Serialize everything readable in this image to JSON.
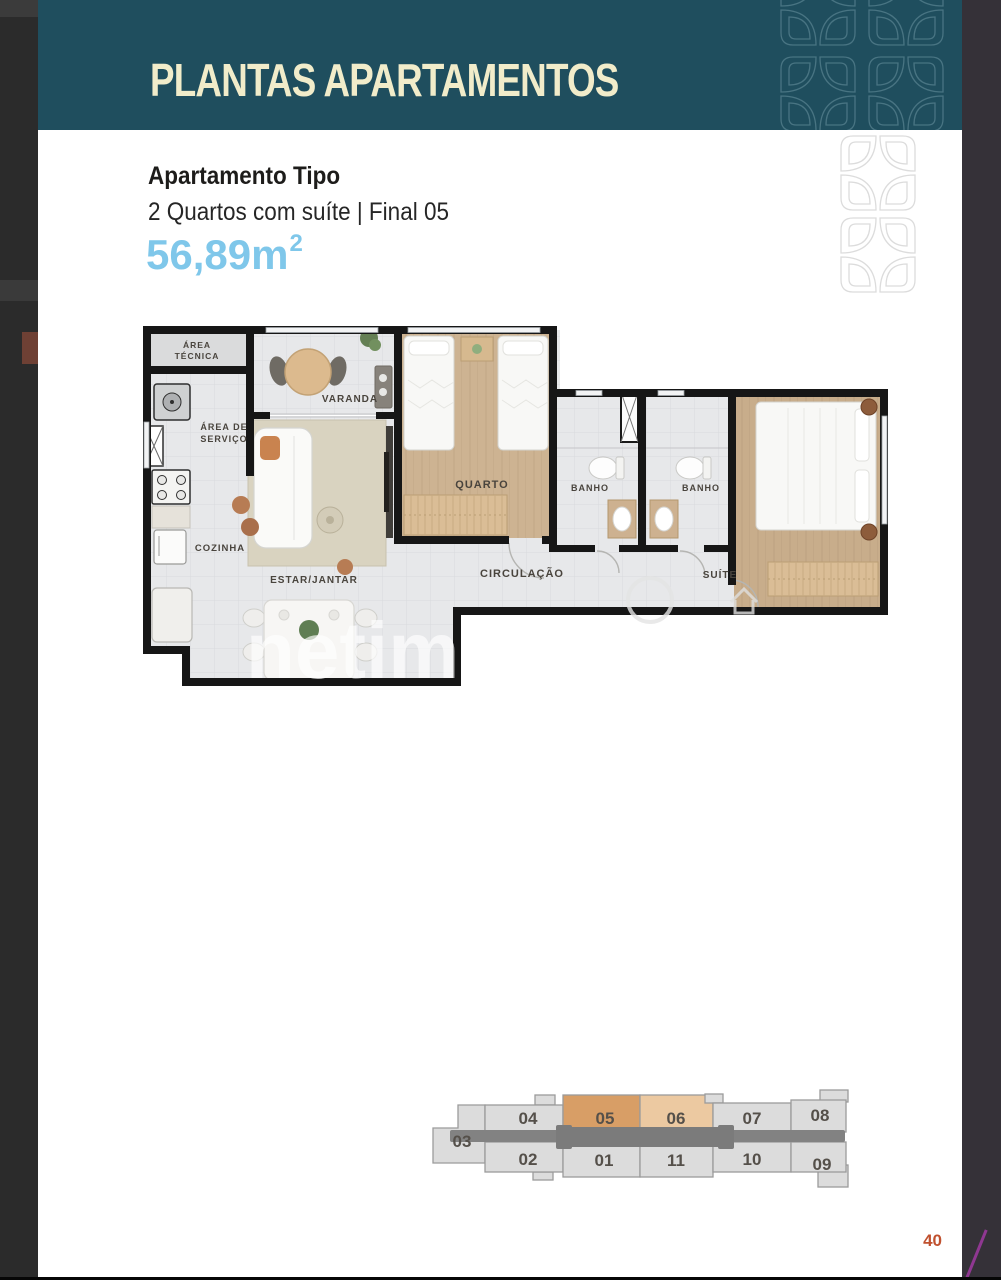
{
  "header": {
    "title": "PLANTAS APARTAMENTOS",
    "bg_color": "#1f4e5e",
    "title_color": "#f1ecca"
  },
  "apartment": {
    "name": "Apartamento Tipo",
    "description": "2 Quartos com suíte | Final 05",
    "area": "56,89m",
    "area_superscript": "2",
    "area_color": "#7fc7ea"
  },
  "floor_plan": {
    "labels": {
      "area_tecnica_line1": "ÁREA",
      "area_tecnica_line2": "TÉCNICA",
      "varanda": "VARANDA",
      "area_servico_line1": "ÁREA DE",
      "area_servico_line2": "SERVIÇO",
      "cozinha": "COZINHA",
      "estar_jantar": "ESTAR/JANTAR",
      "quarto": "QUARTO",
      "banho_1": "BANHO",
      "banho_2": "BANHO",
      "circulacao": "CIRCULAÇÃO",
      "suite": "SUÍTE"
    },
    "watermark": "netim"
  },
  "key_plan": {
    "highlight_primary_color": "#d89e66",
    "highlight_secondary_color": "#ecc9a1",
    "unit_color": "#dcdcdc",
    "corridor_color": "#828282",
    "highlighted_units": [
      "05",
      "06"
    ],
    "units": [
      {
        "label": "03"
      },
      {
        "label": "04"
      },
      {
        "label": "05"
      },
      {
        "label": "06"
      },
      {
        "label": "07"
      },
      {
        "label": "08"
      },
      {
        "label": "02"
      },
      {
        "label": "01"
      },
      {
        "label": "11"
      },
      {
        "label": "10"
      },
      {
        "label": "09"
      }
    ]
  },
  "footer": {
    "page_number": "40",
    "page_number_color": "#c0512f"
  }
}
